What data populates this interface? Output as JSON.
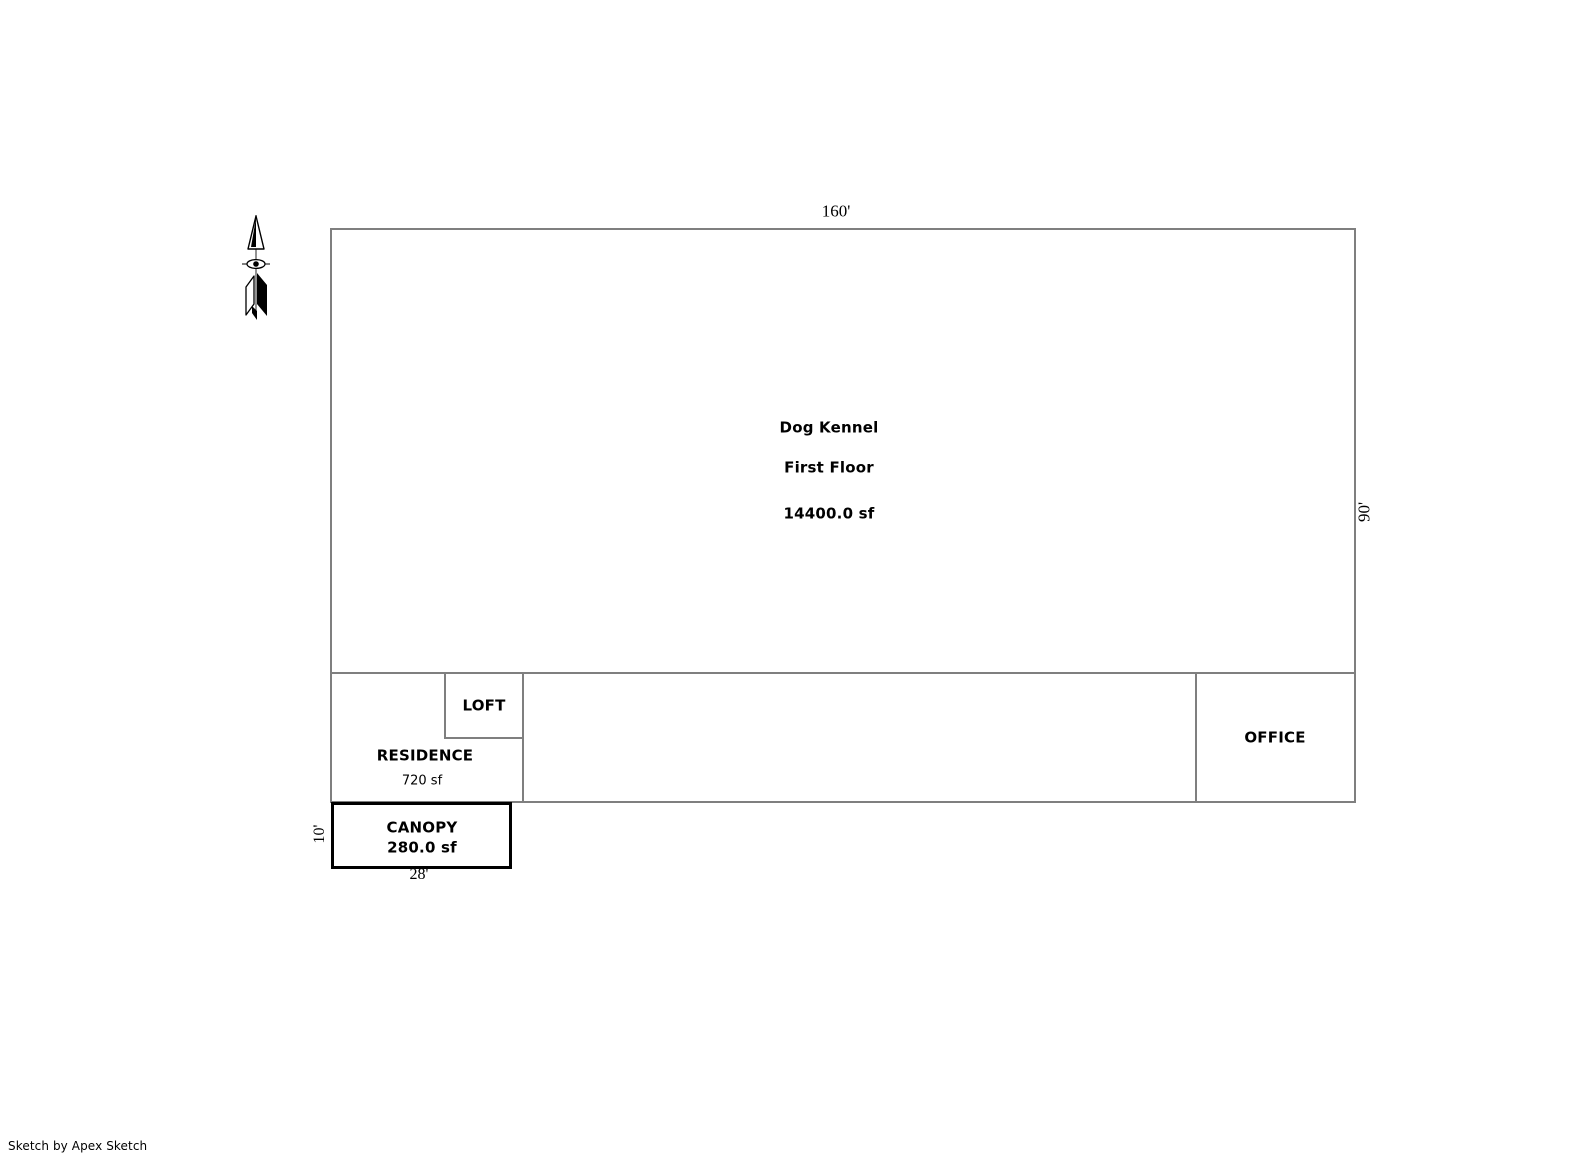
{
  "colors": {
    "wall_line": "#7f7f7f",
    "emphasis_border": "#000000",
    "text": "#000000",
    "background": "#ffffff"
  },
  "icons": {
    "north_arrow": "north-arrow-icon"
  },
  "floor_plan": {
    "building": {
      "name": "Dog Kennel",
      "level": "First Floor",
      "area": "14400.0 sf"
    },
    "dimensions": {
      "top": "160'",
      "right": "90'",
      "canopy_bottom": "28'",
      "canopy_left": "10'"
    },
    "rooms": {
      "loft": {
        "label": "LOFT"
      },
      "residence": {
        "label": "RESIDENCE",
        "area": "720 sf"
      },
      "office": {
        "label": "OFFICE"
      },
      "canopy": {
        "label": "CANOPY",
        "area": "280.0 sf"
      }
    }
  },
  "footer": {
    "credit": "Sketch by Apex Sketch"
  }
}
